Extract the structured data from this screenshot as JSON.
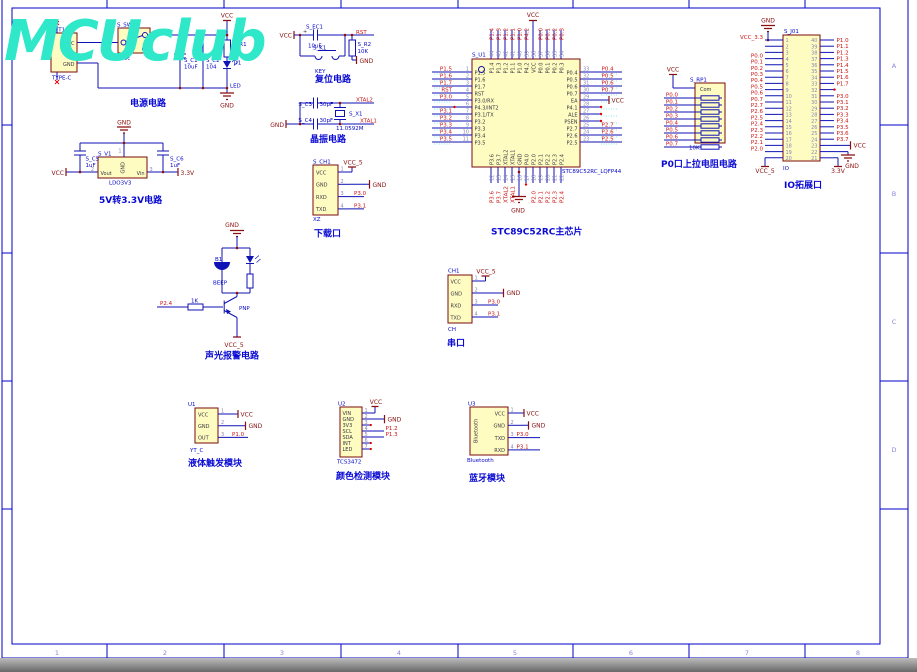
{
  "watermark": "MCUclub",
  "sheet": {
    "zone_numbers": [
      "1",
      "2",
      "3",
      "4",
      "5",
      "6",
      "7",
      "8"
    ],
    "zone_letters": [
      "A",
      "B",
      "C",
      "D"
    ]
  },
  "power": {
    "caption": "电源电路",
    "usb_ref": "S_T1",
    "usb_value": "TYPE-C",
    "usb_pin_vcc": "VCC",
    "usb_pin_gnd": "GND",
    "sw_ref": "S_SW1",
    "sw_value": "开关",
    "c1_ref": "S_C1",
    "c1_value": "10uF",
    "c2_ref": "S_C2",
    "c2_value": "104",
    "r1_ref": "S_R1",
    "r1_value": "1K",
    "d1_ref": "D1",
    "d1_value": "LED",
    "vcc": "VCC",
    "gnd": "GND"
  },
  "ldo": {
    "caption": "5V转3.3V电路",
    "ref": "S_V1",
    "value": "LDO3V3",
    "pin_gnd": "GND",
    "pin_vout": "Vout",
    "pin_vin": "Vin",
    "num_top": "1",
    "num_left": "2",
    "num_right": "3",
    "c5_ref": "S_C5",
    "c5_value": "1uF",
    "c6_ref": "S_C6",
    "c6_value": "1uF",
    "net_left": "VCC",
    "net_right": "3.3V",
    "gnd": "GND"
  },
  "reset": {
    "caption": "复位电路",
    "vcc": "VCC",
    "gnd": "GND",
    "rst": "RST",
    "plus": "+",
    "ec1_ref": "S_EC1",
    "ec1_value": "10uF",
    "k1_ref": "S_K1",
    "k1_value": "KEY",
    "r2_ref": "S_R2",
    "r2_value": "10K"
  },
  "crystal": {
    "caption": "晶振电路",
    "gnd": "GND",
    "c3_ref": "S_C3",
    "c3_value": "30pF",
    "c4_ref": "S_C4",
    "c4_value": "30pF",
    "x1_ref": "S_X1",
    "x1_value": "11.0592M",
    "xtal2": "XTAL2",
    "xtal1": "XTAL1"
  },
  "chip": {
    "caption": "STC89C52RC主芯片",
    "ref": "S_U1",
    "value": "STC89C52RC_LQFP44",
    "vcc": "VCC",
    "gnd": "GND",
    "left_pins": [
      {
        "num": "1",
        "name": "P1.5",
        "net": "P1.5"
      },
      {
        "num": "2",
        "name": "P1.6",
        "net": "P1.6"
      },
      {
        "num": "3",
        "name": "P1.7",
        "net": "P1.7"
      },
      {
        "num": "4",
        "name": "RST",
        "net": "RST"
      },
      {
        "num": "5",
        "name": "P3.0/RX",
        "net": "P3.0"
      },
      {
        "num": "6",
        "name": "P4.3/INT2",
        "net": ""
      },
      {
        "num": "7",
        "name": "P3.1/TX",
        "net": "P3.1"
      },
      {
        "num": "8",
        "name": "P3.2",
        "net": "P3.2"
      },
      {
        "num": "9",
        "name": "P3.3",
        "net": "P3.3"
      },
      {
        "num": "10",
        "name": "P3.4",
        "net": "P3.4"
      },
      {
        "num": "11",
        "name": "P3.5",
        "net": "P3.5"
      }
    ],
    "right_pins": [
      {
        "num": "33",
        "name": "P0.4",
        "net": "P0.4"
      },
      {
        "num": "32",
        "name": "P0.5",
        "net": "P0.5"
      },
      {
        "num": "31",
        "name": "P0.6",
        "net": "P0.6"
      },
      {
        "num": "30",
        "name": "P0.7",
        "net": "P0.7"
      },
      {
        "num": "29",
        "name": "EA",
        "net": ""
      },
      {
        "num": "28",
        "name": "P4.1",
        "net": ""
      },
      {
        "num": "27",
        "name": "ALE",
        "net": ""
      },
      {
        "num": "26",
        "name": "PSEN",
        "net": ""
      },
      {
        "num": "25",
        "name": "P2.7",
        "net": "P2.7"
      },
      {
        "num": "24",
        "name": "P2.6",
        "net": "P2.6"
      },
      {
        "num": "23",
        "name": "P2.5",
        "net": "P2.5"
      }
    ],
    "top_pins": [
      {
        "num": "44",
        "name": "P1.4",
        "net": "P1.4"
      },
      {
        "num": "43",
        "name": "P1.3",
        "net": "P1.3"
      },
      {
        "num": "42",
        "name": "P1.2",
        "net": "P1.2"
      },
      {
        "num": "41",
        "name": "P1.1",
        "net": "P1.1"
      },
      {
        "num": "40",
        "name": "P1.0",
        "net": "P1.0"
      },
      {
        "num": "39",
        "name": "P4.2",
        "net": "P4.2"
      },
      {
        "num": "38",
        "name": "VCC",
        "net": ""
      },
      {
        "num": "37",
        "name": "P0.0",
        "net": "P0.0"
      },
      {
        "num": "36",
        "name": "P0.1",
        "net": "P0.1"
      },
      {
        "num": "35",
        "name": "P0.2",
        "net": "P0.2"
      },
      {
        "num": "34",
        "name": "P0.3",
        "net": "P0.3"
      }
    ],
    "bottom_pins": [
      {
        "num": "12",
        "name": "P3.6",
        "net": "P3.6"
      },
      {
        "num": "13",
        "name": "P3.7",
        "net": "P3.7"
      },
      {
        "num": "14",
        "name": "XTAL2",
        "net": "XTAL2"
      },
      {
        "num": "15",
        "name": "XTAL1",
        "net": "XTAL1"
      },
      {
        "num": "16",
        "name": "GND",
        "net": ""
      },
      {
        "num": "17",
        "name": "P4.0",
        "net": ""
      },
      {
        "num": "18",
        "name": "P2.0",
        "net": "P2.0"
      },
      {
        "num": "19",
        "name": "P2.1",
        "net": "P2.1"
      },
      {
        "num": "20",
        "name": "P2.2",
        "net": "P2.2"
      },
      {
        "num": "21",
        "name": "P2.3",
        "net": "P2.3"
      },
      {
        "num": "22",
        "name": "P2.4",
        "net": "P2.4"
      }
    ]
  },
  "download": {
    "caption": "下载口",
    "ref": "S_CH1",
    "value": "XZ",
    "vcc5": "VCC_5",
    "gnd": "GND",
    "pins": [
      {
        "num": "1",
        "name": "VCC",
        "net": ""
      },
      {
        "num": "2",
        "name": "GND",
        "net": ""
      },
      {
        "num": "3",
        "name": "RXD",
        "net": "P3.0"
      },
      {
        "num": "4",
        "name": "TXD",
        "net": "P3.1"
      }
    ]
  },
  "serial": {
    "caption": "串口",
    "ref": "CH1",
    "value": "CH",
    "vcc5": "VCC_5",
    "gnd": "GND",
    "pins": [
      {
        "num": "1",
        "name": "VCC",
        "net": ""
      },
      {
        "num": "2",
        "name": "GND",
        "net": ""
      },
      {
        "num": "3",
        "name": "RXD",
        "net": "P3.0"
      },
      {
        "num": "4",
        "name": "TXD",
        "net": "P3.1"
      }
    ]
  },
  "alarm": {
    "caption": "声光报警电路",
    "gnd": "GND",
    "vcc5": "VCC_5",
    "b1_ref": "B1",
    "b1_value": "BEEP",
    "q1_value": "PNP",
    "r_value": "1K",
    "net": "P2.4"
  },
  "liquid": {
    "caption": "液体触发模块",
    "ref": "U1",
    "value": "YT_C",
    "vcc": "VCC",
    "gnd": "GND",
    "pins": [
      {
        "num": "1",
        "name": "VCC",
        "net": ""
      },
      {
        "num": "2",
        "name": "GND",
        "net": ""
      },
      {
        "num": "3",
        "name": "OUT",
        "net": "P1.0"
      }
    ]
  },
  "color": {
    "caption": "颜色检测模块",
    "ref": "U2",
    "value": "TCS3472",
    "vcc": "VCC",
    "gnd": "GND",
    "pins": [
      {
        "num": "1",
        "name": "VIN",
        "net": ""
      },
      {
        "num": "2",
        "name": "GND",
        "net": ""
      },
      {
        "num": "3",
        "name": "3V3",
        "net": ""
      },
      {
        "num": "4",
        "name": "SCL",
        "net": "P1.2"
      },
      {
        "num": "5",
        "name": "SDA",
        "net": "P1.3"
      },
      {
        "num": "6",
        "name": "INT",
        "net": ""
      },
      {
        "num": "7",
        "name": "LED",
        "net": ""
      }
    ]
  },
  "bluetooth": {
    "caption": "蓝牙模块",
    "ref": "U3",
    "value": "Bluetooth",
    "body_label": "Bluetooth",
    "vcc": "VCC",
    "gnd": "GND",
    "pins": [
      {
        "num": "1",
        "name": "VCC",
        "net": ""
      },
      {
        "num": "2",
        "name": "GND",
        "net": ""
      },
      {
        "num": "3",
        "name": "TXD",
        "net": "P3.0"
      },
      {
        "num": "4",
        "name": "RXD",
        "net": "P3.1"
      }
    ]
  },
  "pullup": {
    "caption": "P0口上拉电阻电路",
    "ref": "S_RP1",
    "value": "10K",
    "com": "Com",
    "vcc": "VCC",
    "nets": [
      "P0.0",
      "P0.1",
      "P0.2",
      "P0.3",
      "P0.4",
      "P0.5",
      "P0.6",
      "P0.7"
    ]
  },
  "io": {
    "caption": "IO拓展口",
    "ref": "S_J01",
    "value": "IO",
    "gnd": "GND",
    "vcc": "VCC",
    "vcc5": "VCC_5",
    "v33": "3.3V",
    "left_pins": [
      {
        "num": "1",
        "net": "VCC_3.3"
      },
      {
        "num": "2",
        "net": ""
      },
      {
        "num": "3",
        "net": ""
      },
      {
        "num": "4",
        "net": "P0.0"
      },
      {
        "num": "5",
        "net": "P0.1"
      },
      {
        "num": "6",
        "net": "P0.2"
      },
      {
        "num": "7",
        "net": "P0.3"
      },
      {
        "num": "8",
        "net": "P0.4"
      },
      {
        "num": "9",
        "net": "P0.5"
      },
      {
        "num": "10",
        "net": "P0.6"
      },
      {
        "num": "11",
        "net": "P0.7"
      },
      {
        "num": "12",
        "net": "P2.7"
      },
      {
        "num": "13",
        "net": "P2.6"
      },
      {
        "num": "14",
        "net": "P2.5"
      },
      {
        "num": "15",
        "net": "P2.4"
      },
      {
        "num": "16",
        "net": "P2.3"
      },
      {
        "num": "17",
        "net": "P2.2"
      },
      {
        "num": "18",
        "net": "P2.1"
      },
      {
        "num": "19",
        "net": "P2.0"
      },
      {
        "num": "20",
        "net": ""
      }
    ],
    "right_pins": [
      {
        "num": "40",
        "net": "P1.0"
      },
      {
        "num": "39",
        "net": "P1.1"
      },
      {
        "num": "38",
        "net": "P1.2"
      },
      {
        "num": "37",
        "net": "P1.3"
      },
      {
        "num": "36",
        "net": "P1.4"
      },
      {
        "num": "35",
        "net": "P1.5"
      },
      {
        "num": "34",
        "net": "P1.6"
      },
      {
        "num": "33",
        "net": "P1.7"
      },
      {
        "num": "32",
        "net": ""
      },
      {
        "num": "31",
        "net": "P3.0"
      },
      {
        "num": "30",
        "net": "P3.1"
      },
      {
        "num": "29",
        "net": "P3.2"
      },
      {
        "num": "28",
        "net": "P3.3"
      },
      {
        "num": "27",
        "net": "P3.4"
      },
      {
        "num": "26",
        "net": "P3.5"
      },
      {
        "num": "25",
        "net": "P3.6"
      },
      {
        "num": "24",
        "net": "P3.7"
      },
      {
        "num": "23",
        "net": ""
      },
      {
        "num": "22",
        "net": ""
      },
      {
        "num": "21",
        "net": ""
      }
    ]
  }
}
